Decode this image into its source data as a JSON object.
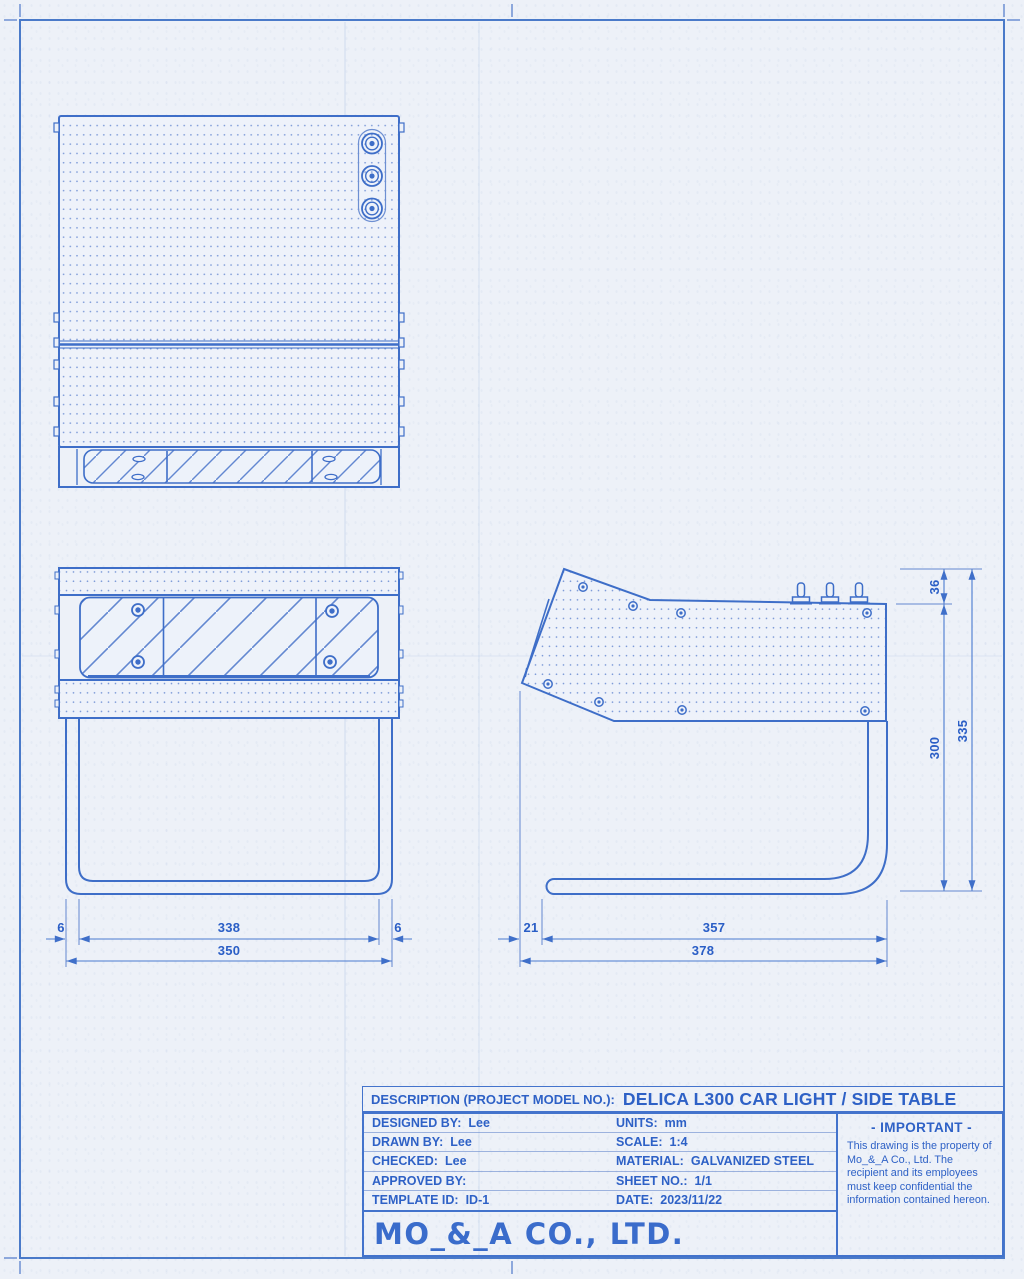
{
  "colors": {
    "line_blue": "#4373cc",
    "text_blue": "#2e61c6",
    "paper": "#edf1f8"
  },
  "dimensions": {
    "front_view": {
      "tube_left": "6",
      "inner_width": "338",
      "tube_right": "6",
      "overall_width": "350"
    },
    "side_view": {
      "front_overhang": "21",
      "base_length": "357",
      "overall_depth": "378"
    },
    "height": {
      "switch_offset": "36",
      "body_height": "300",
      "overall_height": "335"
    }
  },
  "title_block": {
    "description_label": "DESCRIPTION (PROJECT MODEL NO.):",
    "description_value": "DELICA L300 CAR LIGHT / SIDE TABLE",
    "rows": [
      {
        "left_label": "DESIGNED BY:",
        "left_value": "Lee",
        "right_label": "UNITS:",
        "right_value": "mm"
      },
      {
        "left_label": "DRAWN BY:",
        "left_value": "Lee",
        "right_label": "SCALE:",
        "right_value": "1:4"
      },
      {
        "left_label": "CHECKED:",
        "left_value": "Lee",
        "right_label": "MATERIAL:",
        "right_value": "GALVANIZED STEEL"
      },
      {
        "left_label": "APPROVED BY:",
        "left_value": "",
        "right_label": "SHEET NO.:",
        "right_value": "1/1"
      },
      {
        "left_label": "TEMPLATE ID:",
        "left_value": "ID-1",
        "right_label": "DATE:",
        "right_value": "2023/11/22"
      }
    ],
    "company_name": "MO_&_A CO., LTD.",
    "important_notice": {
      "title": "- IMPORTANT -",
      "body": "This drawing is the property of Mo_&_A Co., Ltd. The recipient and its employees must keep confidential the information contained hereon."
    }
  }
}
